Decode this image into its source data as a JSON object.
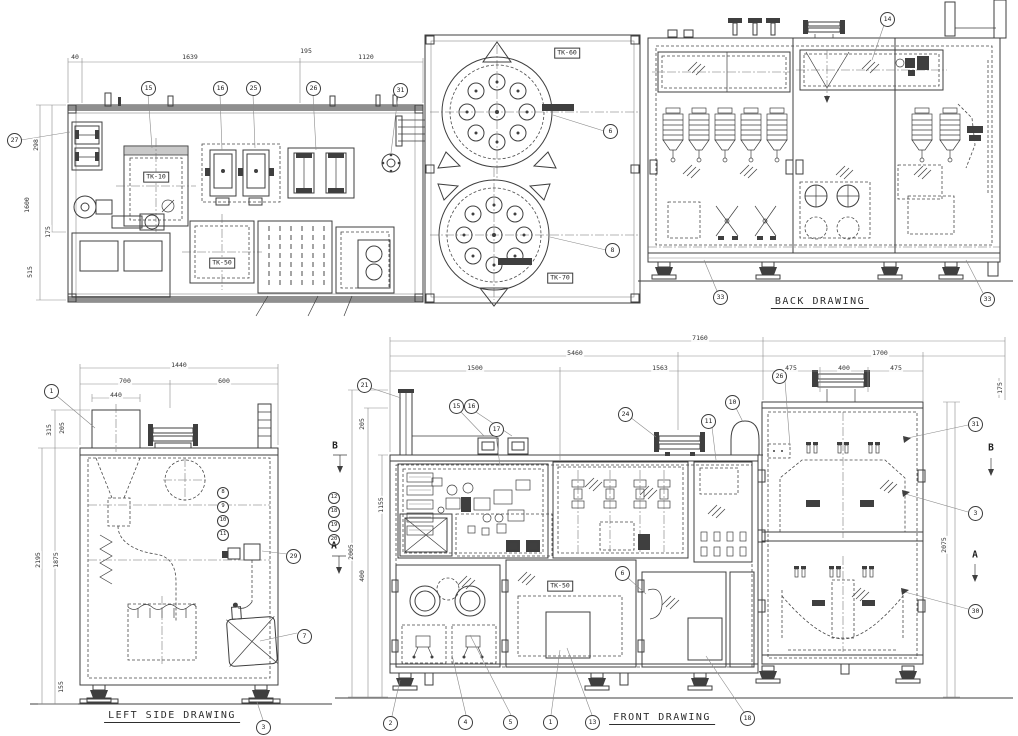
{
  "colors": {
    "ink": "#3f3f3f",
    "background": "#ffffff"
  },
  "views": {
    "plan": {
      "tags": {
        "tk60": "TK-60",
        "tk70": "TK-70",
        "tk10": "TK-10",
        "tk50": "TK-50"
      }
    },
    "back": {
      "label": "BACK DRAWING"
    },
    "left_side": {
      "label": "LEFT SIDE DRAWING"
    },
    "front": {
      "label": "FRONT DRAWING",
      "tag_tk50": "TK-50"
    }
  },
  "balloons": [
    {
      "n": "15",
      "x": 148,
      "y": 88
    },
    {
      "n": "16",
      "x": 220,
      "y": 88
    },
    {
      "n": "25",
      "x": 253,
      "y": 88
    },
    {
      "n": "26",
      "x": 313,
      "y": 88
    },
    {
      "n": "31",
      "x": 400,
      "y": 90
    },
    {
      "n": "27",
      "x": 14,
      "y": 140
    },
    {
      "n": "6",
      "x": 610,
      "y": 131
    },
    {
      "n": "8",
      "x": 612,
      "y": 250
    },
    {
      "n": "14",
      "x": 887,
      "y": 19
    },
    {
      "n": "33",
      "x": 720,
      "y": 297
    },
    {
      "n": "33",
      "x": 987,
      "y": 299
    },
    {
      "n": "1",
      "x": 51,
      "y": 391
    },
    {
      "n": "29",
      "x": 293,
      "y": 556
    },
    {
      "n": "7",
      "x": 304,
      "y": 636
    },
    {
      "n": "3",
      "x": 263,
      "y": 727
    },
    {
      "n": "8",
      "x": 222,
      "y": 492,
      "sm": 1
    },
    {
      "n": "9",
      "x": 222,
      "y": 506,
      "sm": 1
    },
    {
      "n": "10",
      "x": 222,
      "y": 520,
      "sm": 1
    },
    {
      "n": "11",
      "x": 222,
      "y": 534,
      "sm": 1
    },
    {
      "n": "21",
      "x": 364,
      "y": 385
    },
    {
      "n": "15",
      "x": 456,
      "y": 406
    },
    {
      "n": "16",
      "x": 471,
      "y": 406
    },
    {
      "n": "17",
      "x": 496,
      "y": 429
    },
    {
      "n": "24",
      "x": 625,
      "y": 414
    },
    {
      "n": "10",
      "x": 732,
      "y": 402
    },
    {
      "n": "11",
      "x": 708,
      "y": 421
    },
    {
      "n": "26",
      "x": 779,
      "y": 376
    },
    {
      "n": "31",
      "x": 975,
      "y": 424
    },
    {
      "n": "3",
      "x": 975,
      "y": 513
    },
    {
      "n": "30",
      "x": 975,
      "y": 611
    },
    {
      "n": "6",
      "x": 622,
      "y": 573
    },
    {
      "n": "12",
      "x": 333,
      "y": 497,
      "sm": 1
    },
    {
      "n": "18",
      "x": 333,
      "y": 511,
      "sm": 1
    },
    {
      "n": "19",
      "x": 333,
      "y": 525,
      "sm": 1
    },
    {
      "n": "20",
      "x": 333,
      "y": 539,
      "sm": 1
    },
    {
      "n": "2",
      "x": 390,
      "y": 723
    },
    {
      "n": "4",
      "x": 465,
      "y": 722
    },
    {
      "n": "5",
      "x": 510,
      "y": 722
    },
    {
      "n": "1",
      "x": 550,
      "y": 722
    },
    {
      "n": "13",
      "x": 592,
      "y": 722
    },
    {
      "n": "18",
      "x": 747,
      "y": 718
    }
  ],
  "dimensions": [
    {
      "t": "40",
      "x": 75,
      "y": 57
    },
    {
      "t": "1639",
      "x": 190,
      "y": 57
    },
    {
      "t": "195",
      "x": 306,
      "y": 51
    },
    {
      "t": "1120",
      "x": 366,
      "y": 57
    },
    {
      "t": "298",
      "x": 36,
      "y": 145,
      "r": 1
    },
    {
      "t": "1600",
      "x": 27,
      "y": 205,
      "r": 1
    },
    {
      "t": "175",
      "x": 48,
      "y": 232,
      "r": 1
    },
    {
      "t": "515",
      "x": 30,
      "y": 272,
      "r": 1
    },
    {
      "t": "1440",
      "x": 179,
      "y": 365
    },
    {
      "t": "700",
      "x": 125,
      "y": 381
    },
    {
      "t": "600",
      "x": 224,
      "y": 381
    },
    {
      "t": "440",
      "x": 116,
      "y": 395
    },
    {
      "t": "315",
      "x": 49,
      "y": 430,
      "r": 1
    },
    {
      "t": "205",
      "x": 62,
      "y": 428,
      "r": 1
    },
    {
      "t": "2195",
      "x": 38,
      "y": 560,
      "r": 1
    },
    {
      "t": "1875",
      "x": 56,
      "y": 560,
      "r": 1
    },
    {
      "t": "155",
      "x": 61,
      "y": 687,
      "r": 1
    },
    {
      "t": "7160",
      "x": 700,
      "y": 338
    },
    {
      "t": "5460",
      "x": 575,
      "y": 353
    },
    {
      "t": "1700",
      "x": 880,
      "y": 353
    },
    {
      "t": "1500",
      "x": 475,
      "y": 368
    },
    {
      "t": "1563",
      "x": 660,
      "y": 368
    },
    {
      "t": "475",
      "x": 791,
      "y": 368
    },
    {
      "t": "400",
      "x": 844,
      "y": 368
    },
    {
      "t": "475",
      "x": 896,
      "y": 368
    },
    {
      "t": "205",
      "x": 362,
      "y": 424,
      "r": 1
    },
    {
      "t": "1155",
      "x": 381,
      "y": 505,
      "r": 1
    },
    {
      "t": "2005",
      "x": 351,
      "y": 552,
      "r": 1
    },
    {
      "t": "400",
      "x": 362,
      "y": 576,
      "r": 1
    },
    {
      "t": "2075",
      "x": 944,
      "y": 545,
      "r": 1
    },
    {
      "t": "175",
      "x": 1000,
      "y": 388,
      "r": 1
    }
  ],
  "section_markers": [
    {
      "l": "B",
      "x": 335,
      "y": 446
    },
    {
      "l": "A",
      "x": 334,
      "y": 546
    },
    {
      "l": "B",
      "x": 991,
      "y": 448
    },
    {
      "l": "A",
      "x": 975,
      "y": 555
    }
  ]
}
